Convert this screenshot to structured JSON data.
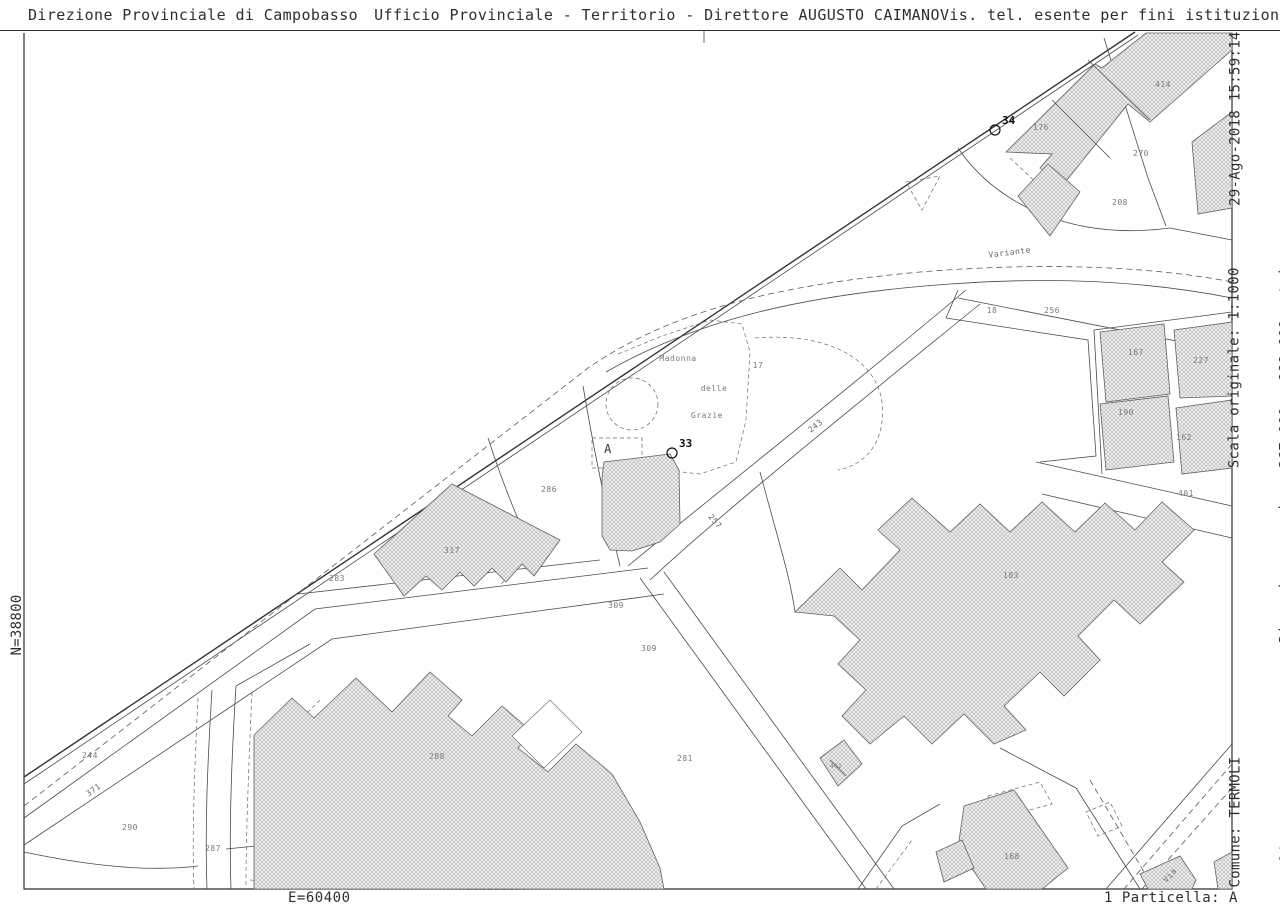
{
  "header": {
    "left": "Direzione Provinciale di Campobasso",
    "center": "Ufficio Provinciale - Territorio - Direttore AUGUSTO CAIMANO",
    "right": "Vis. tel. esente per fini istituzionali"
  },
  "margins": {
    "left_vertical": "N=38800",
    "bottom_left": "E=60400",
    "bottom_right": "1 Particella: A",
    "right_top": [
      "29-Ago-2018 15:59:14",
      "Prot. n. T157777/2018"
    ],
    "right_middle": [
      "Scala originale: 1:1000",
      "Dimensione cornice: 267.000 x 189.000 metri"
    ],
    "right_bottom": [
      "Comune: TERMOLI",
      "Foglio:  14"
    ]
  },
  "map": {
    "labels": [
      {
        "t": "176",
        "x": 1041,
        "y": 130
      },
      {
        "t": "414",
        "x": 1163,
        "y": 87
      },
      {
        "t": "270",
        "x": 1141,
        "y": 156
      },
      {
        "t": "208",
        "x": 1120,
        "y": 205
      },
      {
        "t": "Variante",
        "x": 1010,
        "y": 255,
        "r": -7,
        "cls": "road"
      },
      {
        "t": "18",
        "x": 992,
        "y": 313
      },
      {
        "t": "256",
        "x": 1052,
        "y": 313
      },
      {
        "t": "167",
        "x": 1136,
        "y": 355
      },
      {
        "t": "227",
        "x": 1201,
        "y": 363
      },
      {
        "t": "190",
        "x": 1126,
        "y": 415
      },
      {
        "t": "162",
        "x": 1184,
        "y": 440
      },
      {
        "t": "Madonna",
        "x": 678,
        "y": 361
      },
      {
        "t": "17",
        "x": 758,
        "y": 368
      },
      {
        "t": "delle",
        "x": 714,
        "y": 391
      },
      {
        "t": "Grazie",
        "x": 707,
        "y": 418
      },
      {
        "t": "243",
        "x": 817,
        "y": 428,
        "r": -38,
        "cls": "road"
      },
      {
        "t": "A",
        "x": 608,
        "y": 453,
        "cls": "big"
      },
      {
        "t": "286",
        "x": 549,
        "y": 492
      },
      {
        "t": "401",
        "x": 1186,
        "y": 496
      },
      {
        "t": "257",
        "x": 713,
        "y": 523,
        "r": 50,
        "cls": "road"
      },
      {
        "t": "317",
        "x": 452,
        "y": 553
      },
      {
        "t": "103",
        "x": 1011,
        "y": 578
      },
      {
        "t": "283",
        "x": 337,
        "y": 581
      },
      {
        "t": "309",
        "x": 616,
        "y": 608
      },
      {
        "t": "309",
        "x": 649,
        "y": 651
      },
      {
        "t": "244",
        "x": 90,
        "y": 758
      },
      {
        "t": "288",
        "x": 437,
        "y": 759
      },
      {
        "t": "281",
        "x": 685,
        "y": 761
      },
      {
        "t": "402",
        "x": 836,
        "y": 768,
        "cls": "tiny"
      },
      {
        "t": "371",
        "x": 95,
        "y": 792,
        "r": -36,
        "cls": "road"
      },
      {
        "t": "290",
        "x": 130,
        "y": 830
      },
      {
        "t": "287",
        "x": 213,
        "y": 851
      },
      {
        "t": "168",
        "x": 1012,
        "y": 859
      },
      {
        "t": "Via",
        "x": 1172,
        "y": 877,
        "r": -49,
        "cls": "road"
      }
    ],
    "points": [
      {
        "label": "34",
        "x": 995,
        "y": 130
      },
      {
        "label": "33",
        "x": 672,
        "y": 453
      }
    ]
  },
  "colors": {
    "frame_line": "#2f2f2f",
    "road_line": "#333333",
    "parcel_line": "#4a4a4a",
    "dashed_line": "#5a5a5a",
    "building_outline": "#5f5f5f",
    "building_hatch": "#b5b5b5",
    "label_gray": "#7a7a7a",
    "text": "#2e2e2e",
    "background": "#ffffff"
  }
}
